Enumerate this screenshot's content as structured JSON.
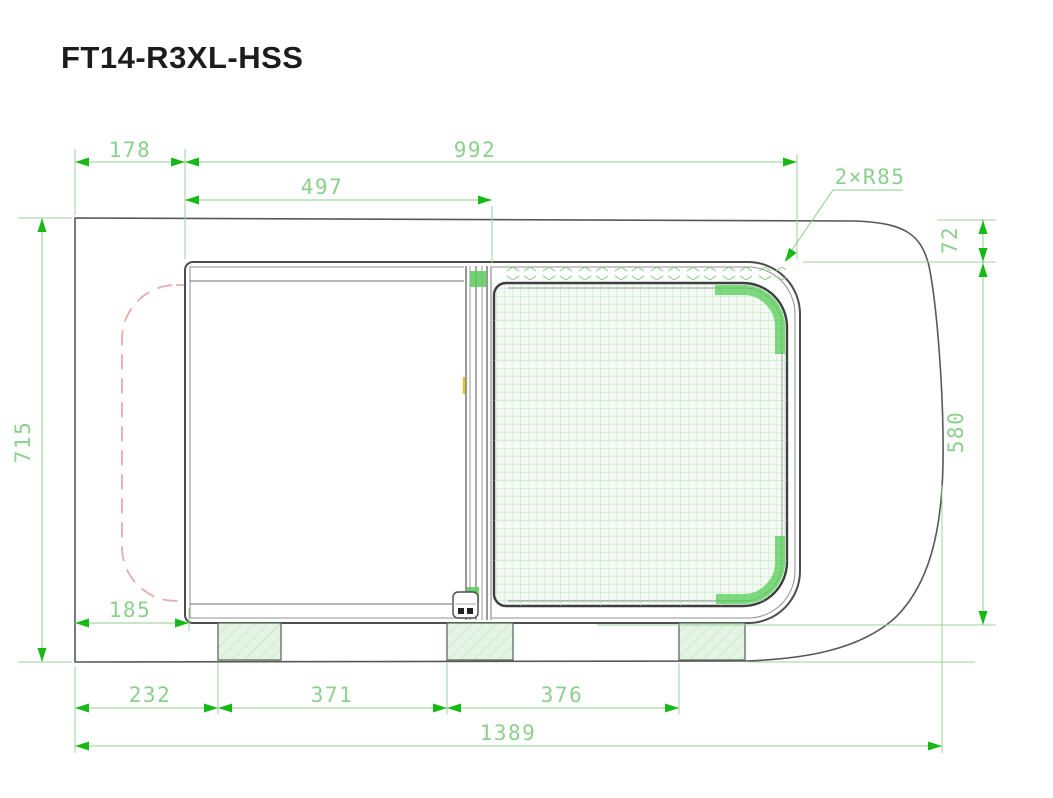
{
  "title": "FT14-R3XL-HSS",
  "drawing": {
    "type": "technical-drawing-sliding-window",
    "dimensions": {
      "left_offset_top": "178",
      "frame_width": "992",
      "opening_width": "497",
      "corner_radius_note": "2×R85",
      "top_drop": "72",
      "body_height": "715",
      "frame_height": "580",
      "bottom_left_offset": "185",
      "bracket_offset": "232",
      "bracket_spacing_1": "371",
      "bracket_spacing_2": "376",
      "total_width": "1389"
    },
    "colors": {
      "dimension_line": "#8fcc8f",
      "dimension_text": "#8bd08b",
      "arrow": "#16b916",
      "body_outline": "#585858",
      "frame_outline": "#4d4d4d",
      "phantom_dashed": "#e7abab",
      "mesh_grid": "#c6e7c6",
      "corner_accent": "#55cd55",
      "bracket_fill": "#e4f4e4",
      "highlight_tick": "#d6ce2e"
    }
  }
}
